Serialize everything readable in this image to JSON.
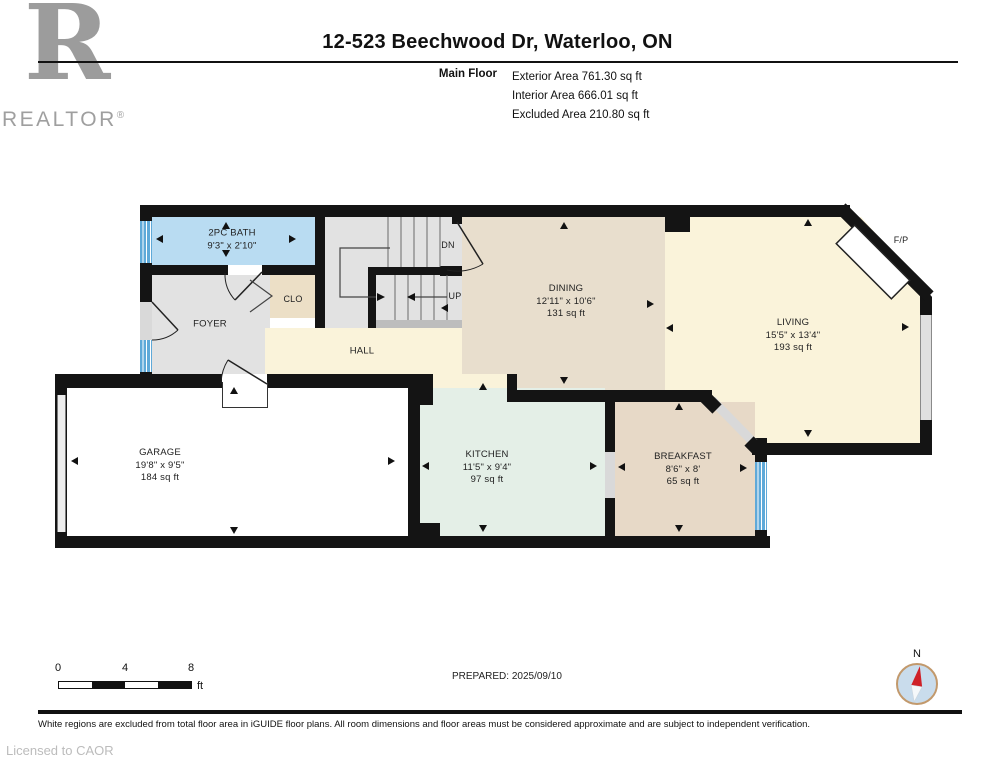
{
  "header": {
    "title": "12-523 Beechwood Dr, Waterloo, ON",
    "floor_label": "Main Floor",
    "areas": [
      "Exterior Area 761.30 sq ft",
      "Interior Area 666.01 sq ft",
      "Excluded Area 210.80 sq ft"
    ]
  },
  "logo": {
    "letter": "R",
    "brand": "REALTOR",
    "registered": "®"
  },
  "rooms": {
    "bath": {
      "name": "2PC BATH",
      "dims": "9'3\" x 2'10\""
    },
    "foyer": {
      "name": "FOYER"
    },
    "closet": {
      "name": "CLO"
    },
    "hall": {
      "name": "HALL"
    },
    "stairs": {
      "down": "DN",
      "up": "UP"
    },
    "dining": {
      "name": "DINING",
      "dims": "12'11\" x 10'6\"",
      "area": "131 sq ft"
    },
    "living": {
      "name": "LIVING",
      "dims": "15'5\" x 13'4\"",
      "area": "193 sq ft"
    },
    "fireplace": {
      "name": "F/P"
    },
    "kitchen": {
      "name": "KITCHEN",
      "dims": "11'5\" x 9'4\"",
      "area": "97 sq ft"
    },
    "breakfast": {
      "name": "BREAKFAST",
      "dims": "8'6\" x 8'",
      "area": "65 sq ft"
    },
    "garage": {
      "name": "GARAGE",
      "dims": "19'8\" x 9'5\"",
      "area": "184 sq ft"
    }
  },
  "footer": {
    "scale": {
      "ticks": [
        "0",
        "4",
        "8"
      ],
      "unit": "ft"
    },
    "prepared": "PREPARED: 2025/09/10",
    "compass": {
      "north": "N"
    },
    "disclaimer": "White regions are excluded from total floor area in iGUIDE floor plans. All room dimensions and floor areas must be considered approximate and are subject to independent verification.",
    "license": "Licensed to CAOR"
  },
  "colors": {
    "wall": "#141414",
    "bath": "#b9dcf2",
    "foyer_stairs": "#e2e2e2",
    "closet": "#ecdfc6",
    "hall_living": "#faf3da",
    "dining": "#e8decd",
    "kitchen": "#e4efe7",
    "breakfast": "#e7d9c7",
    "garage": "#ffffff",
    "window": "#5fa9d8",
    "compass_fill": "#c9dcec",
    "compass_ring": "#c2996c",
    "needle_red": "#cf2128",
    "logo_gray": "#9c9c9c"
  }
}
